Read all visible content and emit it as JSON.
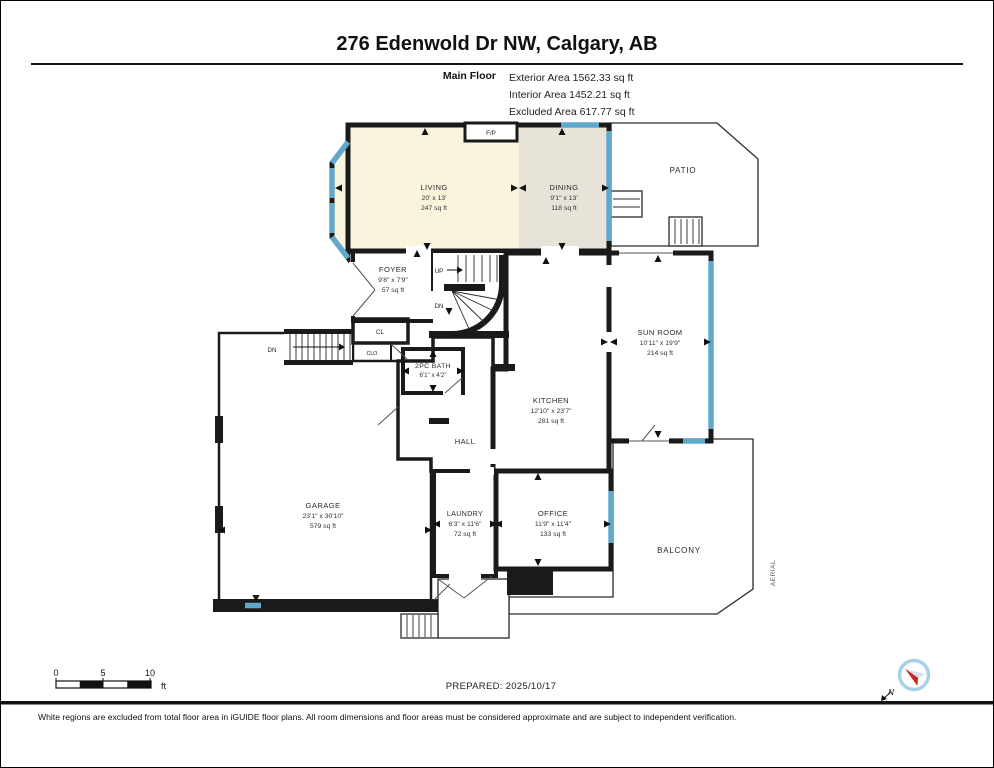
{
  "header": {
    "title": "276 Edenwold Dr NW, Calgary, AB",
    "floor_label": "Main Floor",
    "area_lines": [
      "Exterior Area 1562.33 sq ft",
      "Interior Area 1452.21 sq ft",
      "Excluded Area 617.77 sq ft"
    ]
  },
  "rooms": {
    "living": {
      "name": "LIVING",
      "dims": "20' x 13'",
      "area": "247 sq ft"
    },
    "dining": {
      "name": "DINING",
      "dims": "9'1\" x 13'",
      "area": "118 sq ft"
    },
    "patio": {
      "name": "PATIO"
    },
    "foyer": {
      "name": "FOYER",
      "dims": "9'8\" x 7'9\"",
      "area": "57 sq ft"
    },
    "closet": {
      "name": "CL"
    },
    "closet2": {
      "name": "CLO"
    },
    "fireplace": {
      "name": "F/P"
    },
    "stairs_up": {
      "name": "UP"
    },
    "stairs_dn": {
      "name": "DN"
    },
    "stairs_dn_garage": {
      "name": "DN"
    },
    "sun_room": {
      "name": "SUN ROOM",
      "dims": "10'11\" x 19'9\"",
      "area": "214 sq ft"
    },
    "bath": {
      "name": "2PC BATH",
      "dims": "6'1\" x 4'2\""
    },
    "kitchen": {
      "name": "KITCHEN",
      "dims": "12'10\" x 23'7\"",
      "area": "281 sq ft"
    },
    "hall": {
      "name": "HALL"
    },
    "garage": {
      "name": "GARAGE",
      "dims": "23'1\" x 30'10\"",
      "area": "579 sq ft"
    },
    "laundry": {
      "name": "LAUNDRY",
      "dims": "6'3\" x 11'6\"",
      "area": "72 sq ft"
    },
    "office": {
      "name": "OFFICE",
      "dims": "11'9\" x 11'4\"",
      "area": "133 sq ft"
    },
    "balcony": {
      "name": "BALCONY"
    },
    "aerial_label": "AERIAL"
  },
  "footer": {
    "scale_ticks": [
      "0",
      "5",
      "10"
    ],
    "scale_unit": "ft",
    "prepared": "PREPARED: 2025/10/17",
    "north_label": "N",
    "disclaimer": "White regions are excluded from total floor area in iGUIDE floor plans. All room dimensions and floor areas must be considered approximate and are subject to independent verification."
  },
  "colors": {
    "cream": "#FBF4DC",
    "tan": "#E8E3D8",
    "gray": "#DCDCDA",
    "kitchen_green": "#E2EDE7",
    "bath_blue": "#A7D1E7",
    "window_blue": "#62A8CC",
    "wall_black": "#1A1A1A"
  }
}
